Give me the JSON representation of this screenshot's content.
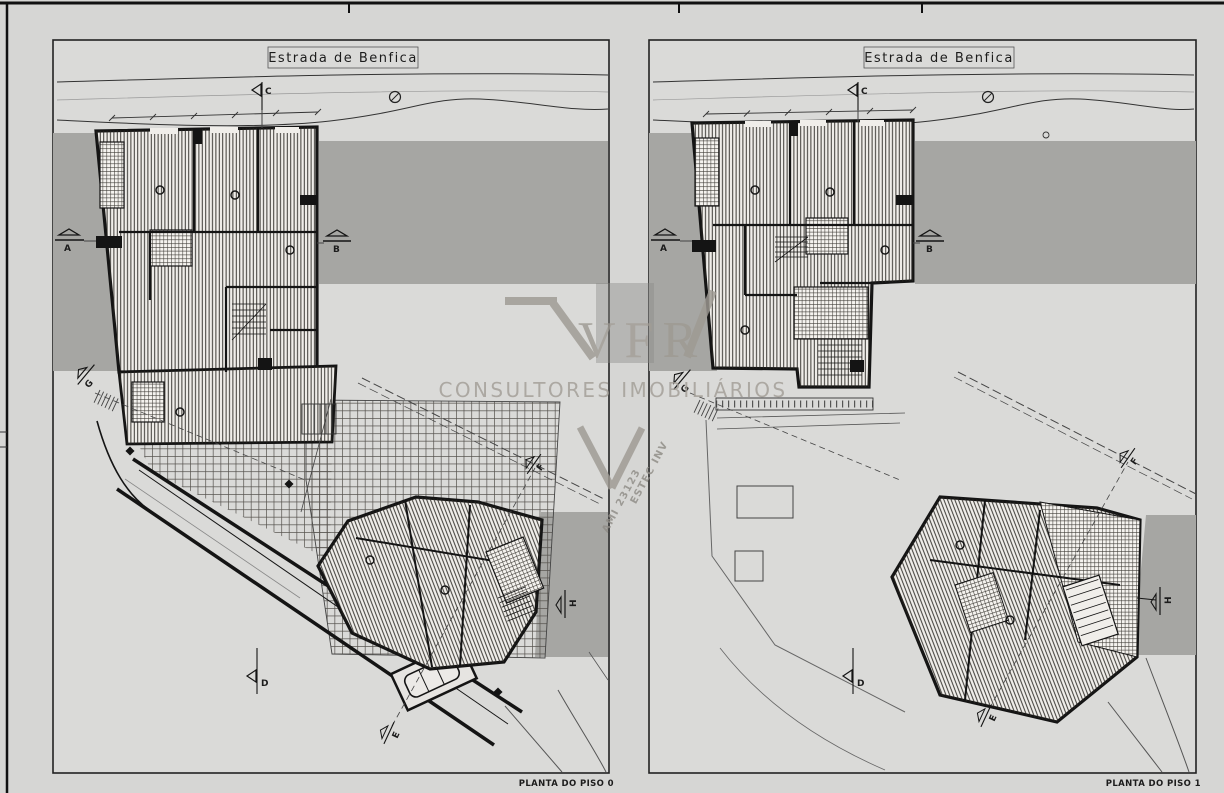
{
  "drawing": {
    "type": "architectural site / floor plan sheet",
    "panels": [
      {
        "street_label": "Estrada de Benfica",
        "caption": "PLANTA DO PISO 0"
      },
      {
        "street_label": "Estrada de Benfica",
        "caption": "PLANTA DO PISO 1"
      }
    ],
    "section_markers": {
      "a": "A",
      "b": "B",
      "c": "C",
      "d": "D",
      "e": "E",
      "f": "F",
      "g": "G",
      "h": "H"
    },
    "watermark": {
      "brand": "VFR",
      "subtitle": "CONSULTORES IMOBILIÁRIOS",
      "company": "ESTEC INV",
      "license": "AMI 23123"
    },
    "colors": {
      "background": "#d6d6d4",
      "neighbor_gray": "#a6a6a3",
      "ink": "#1c1c1c",
      "building_fill": "#f0eeea",
      "watermark": "#9e9a93"
    }
  }
}
